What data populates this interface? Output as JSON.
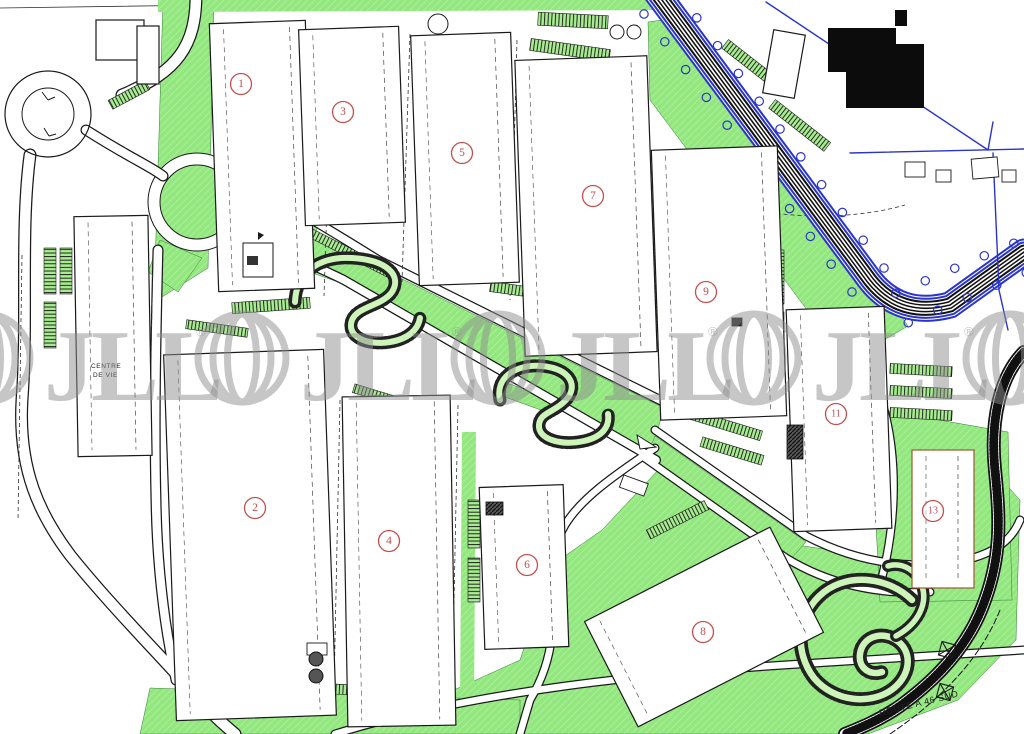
{
  "plan": {
    "kind": "industrial-park-site-plan",
    "width": 1024,
    "height": 734
  },
  "colors": {
    "grass": "#93e77f",
    "grass_light": "#aef09a",
    "line": "#1a1a1a",
    "blue": "#2a35c8",
    "badge_red": "#c0504d",
    "watermark_gray": "#8e8e8e",
    "plot13_stroke": "#9a5b2d"
  },
  "labels": {
    "centre_line1": "CENTRE",
    "centre_line2": "DE VIE",
    "route": "ROUTE A 46 SUD"
  },
  "watermark": {
    "text": "JLL",
    "registered": "®",
    "units_x": [
      -60,
      196,
      452,
      708,
      964
    ],
    "cy": 358,
    "globe_r": 44,
    "font_size": 102,
    "opacity": 0.5
  },
  "badges": [
    {
      "n": "1",
      "x": 241,
      "y": 84
    },
    {
      "n": "2",
      "x": 255,
      "y": 508
    },
    {
      "n": "3",
      "x": 343,
      "y": 112
    },
    {
      "n": "4",
      "x": 389,
      "y": 541
    },
    {
      "n": "5",
      "x": 462,
      "y": 153
    },
    {
      "n": "6",
      "x": 527,
      "y": 565
    },
    {
      "n": "7",
      "x": 593,
      "y": 196
    },
    {
      "n": "8",
      "x": 703,
      "y": 632
    },
    {
      "n": "9",
      "x": 706,
      "y": 292
    },
    {
      "n": "11",
      "x": 836,
      "y": 414
    },
    {
      "n": "13",
      "x": 933,
      "y": 511
    }
  ],
  "buildings": [
    {
      "plot": "1",
      "x": 214,
      "y": 22,
      "w": 96,
      "h": 268,
      "rot": -2
    },
    {
      "plot": "3",
      "x": 302,
      "y": 28,
      "w": 100,
      "h": 196,
      "rot": -2
    },
    {
      "plot": "5",
      "x": 415,
      "y": 34,
      "w": 100,
      "h": 250,
      "rot": -2
    },
    {
      "plot": "7",
      "x": 520,
      "y": 58,
      "w": 132,
      "h": 296,
      "rot": -2
    },
    {
      "plot": "9",
      "x": 656,
      "y": 148,
      "w": 126,
      "h": 270,
      "rot": -2
    },
    {
      "plot": "11",
      "x": 790,
      "y": 308,
      "w": 98,
      "h": 222,
      "rot": -2
    },
    {
      "plot": "13",
      "x": 912,
      "y": 450,
      "w": 62,
      "h": 138,
      "rot": 0,
      "stroke": "#9a5b2d"
    },
    {
      "plot": "2",
      "x": 170,
      "y": 352,
      "w": 160,
      "h": 366,
      "rot": -2
    },
    {
      "plot": "4",
      "x": 345,
      "y": 396,
      "w": 108,
      "h": 330,
      "rot": -1
    },
    {
      "plot": "6",
      "x": 482,
      "y": 486,
      "w": 84,
      "h": 162,
      "rot": -2
    },
    {
      "plot": "8",
      "x": 600,
      "y": 568,
      "w": 208,
      "h": 118,
      "rot": -27
    },
    {
      "plot": "centre-de-vie",
      "x": 76,
      "y": 216,
      "w": 74,
      "h": 240,
      "rot": -1
    },
    {
      "plot": "annex-a",
      "x": 96,
      "y": 20,
      "w": 48,
      "h": 40,
      "rot": 0
    },
    {
      "plot": "annex-b",
      "x": 137,
      "y": 26,
      "w": 22,
      "h": 58,
      "rot": 0
    },
    {
      "plot": "annex-c",
      "x": 768,
      "y": 32,
      "w": 32,
      "h": 64,
      "rot": 10
    }
  ],
  "highway_trees": {
    "segA": {
      "x1": 660,
      "y1": 2,
      "x2": 868,
      "y2": 280,
      "count": 11,
      "offset": 20
    },
    "segB": {
      "x1": 902,
      "y1": 308,
      "x2": 1020,
      "y2": 258,
      "count": 5,
      "offset": 16
    }
  }
}
